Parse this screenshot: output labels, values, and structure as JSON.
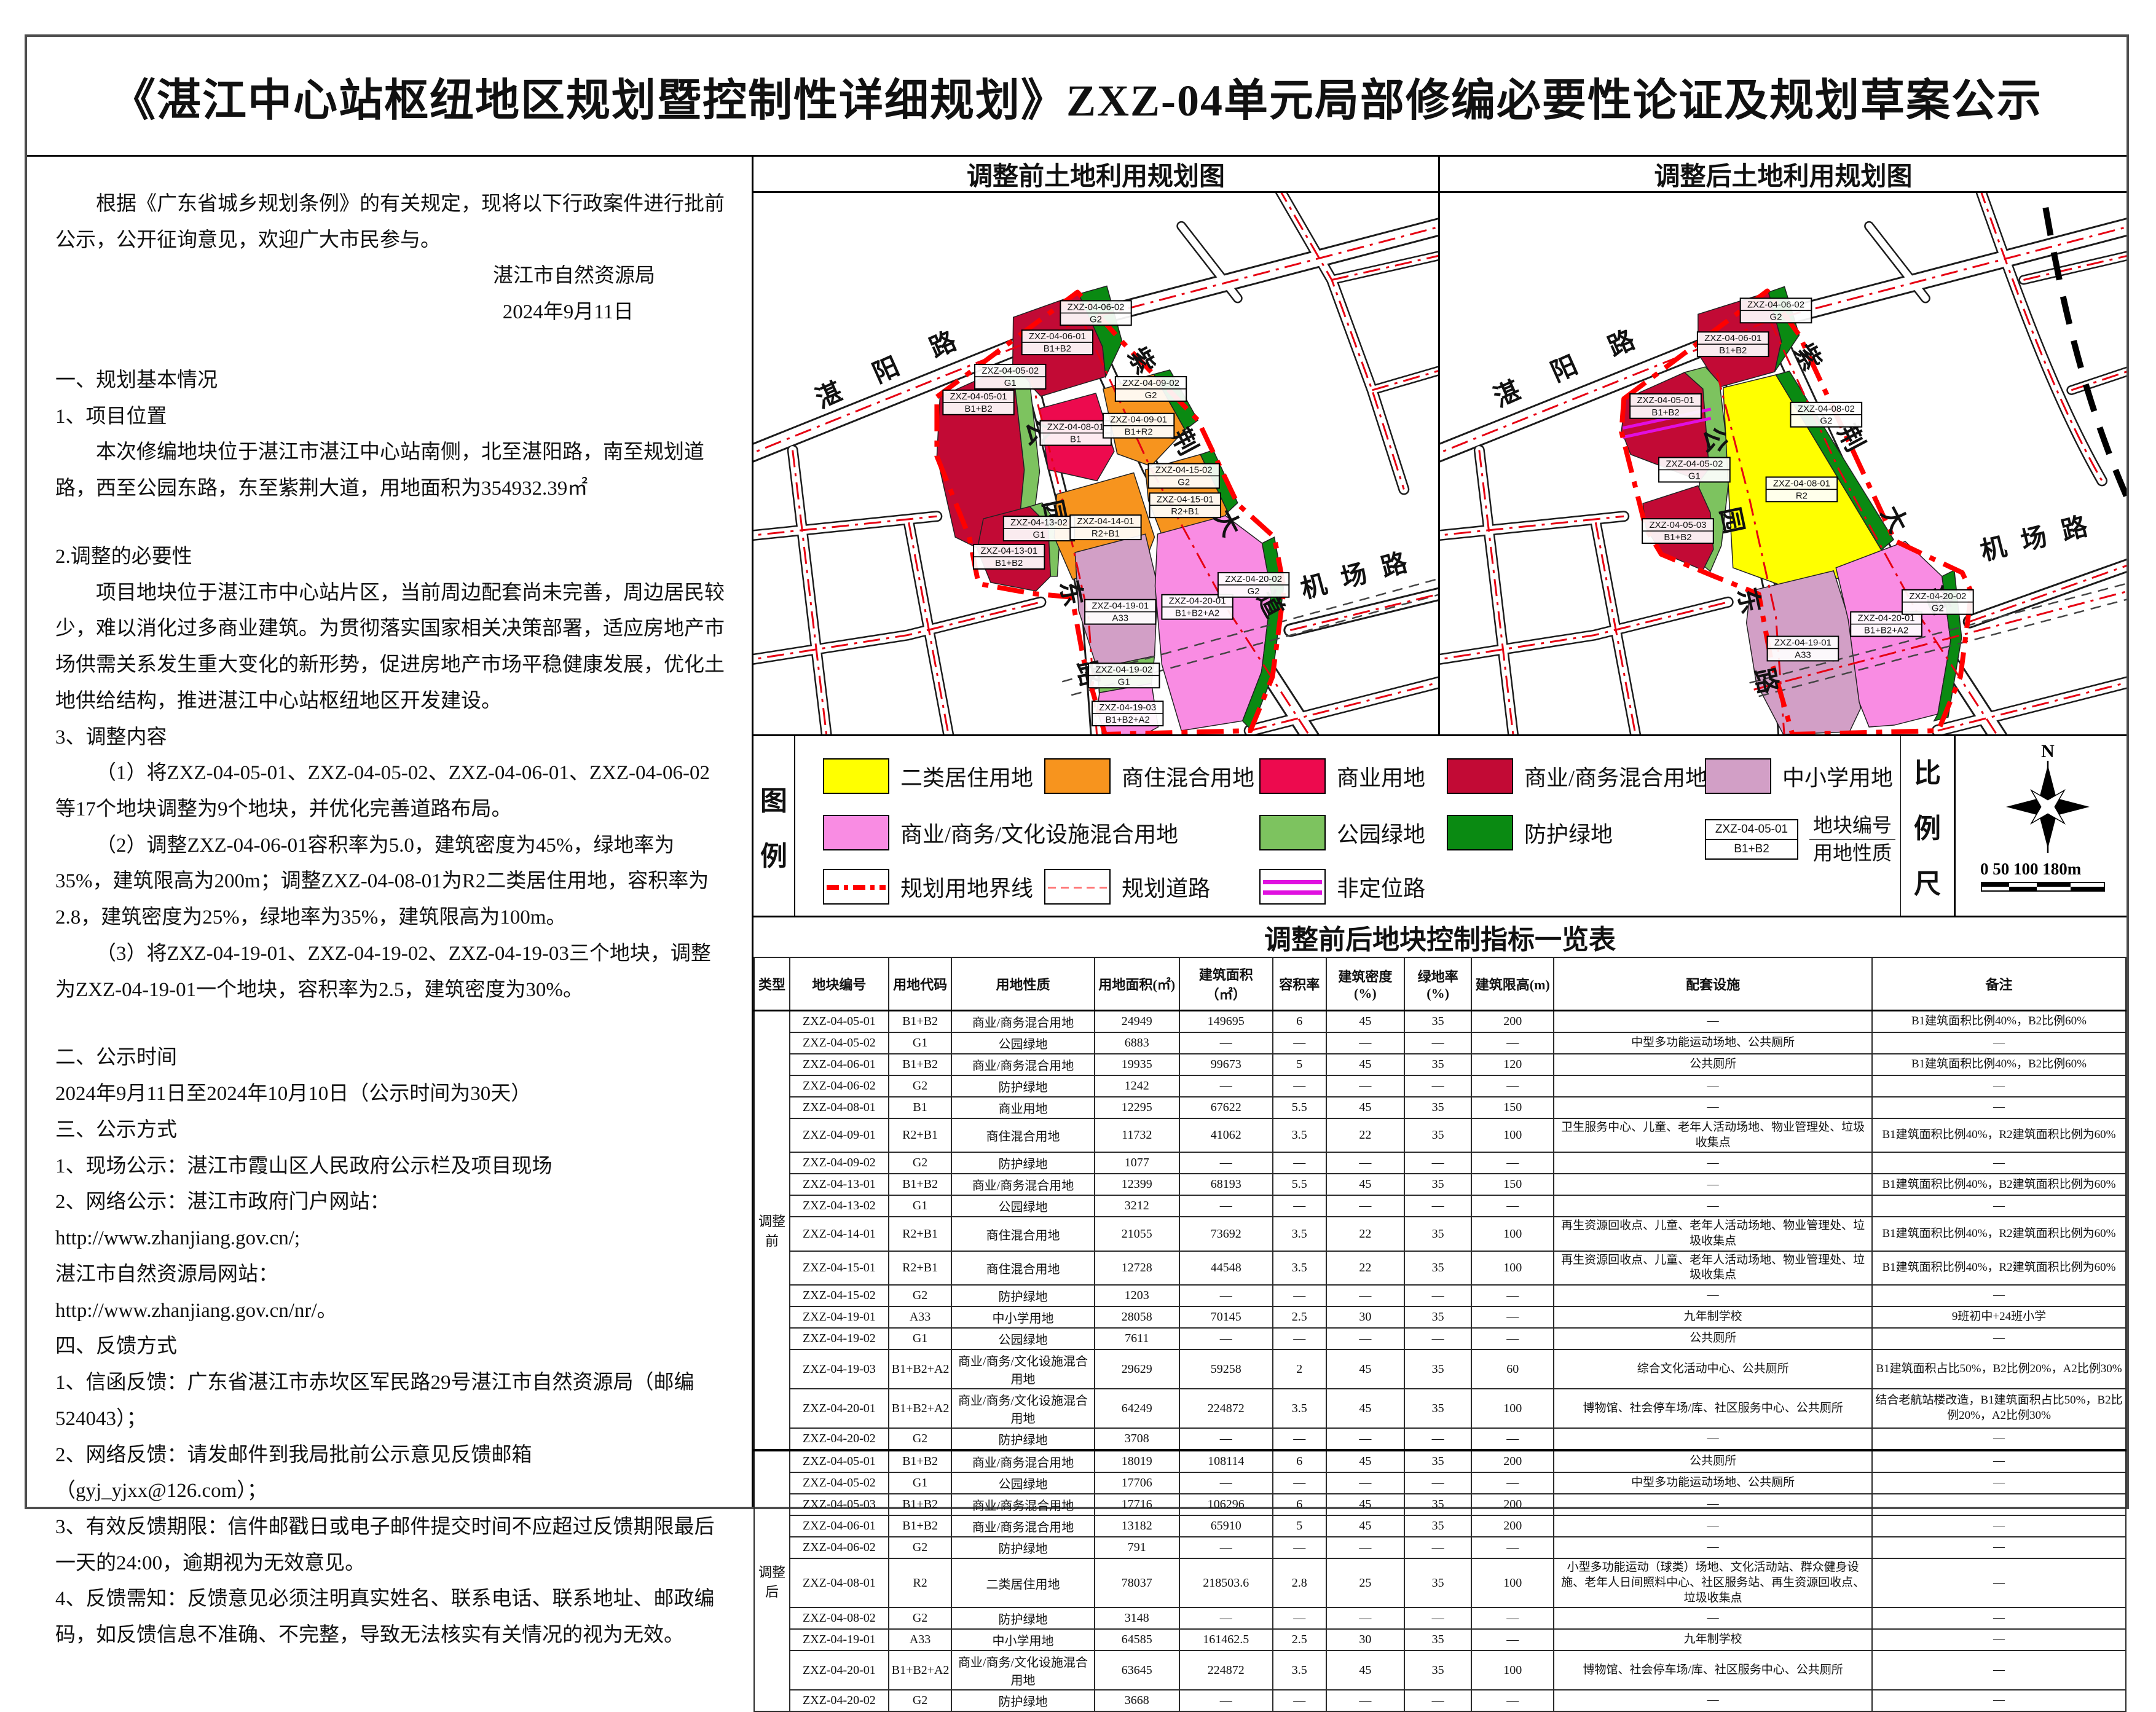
{
  "sheet": {
    "title": "《湛江中心站枢纽地区规划暨控制性详细规划》ZXZ-04单元局部修编必要性论证及规划草案公示"
  },
  "notice": {
    "lines": [
      "根据《广东省城乡规划条例》的有关规定，现将以下行政案件进行批前公示，公开征询意见，欢迎广大市民参与。",
      "湛江市自然资源局",
      "2024年9月11日",
      "一、规划基本情况",
      "1、项目位置",
      "本次修编地块位于湛江市湛江中心站南侧，北至湛阳路，南至规划道路，西至公园东路，东至紫荆大道，用地面积为354932.39㎡",
      "2.调整的必要性",
      "项目地块位于湛江市中心站片区，当前周边配套尚未完善，周边居民较少，难以消化过多商业建筑。为贯彻落实国家相关决策部署，适应房地产市场供需关系发生重大变化的新形势，促进房地产市场平稳健康发展，优化土地供给结构，推进湛江中心站枢纽地区开发建设。",
      "3、调整内容",
      "（1）将ZXZ-04-05-01、ZXZ-04-05-02、ZXZ-04-06-01、ZXZ-04-06-02等17个地块调整为9个地块，并优化完善道路布局。",
      "（2）调整ZXZ-04-06-01容积率为5.0，建筑密度为45%，绿地率为35%，建筑限高为200m；调整ZXZ-04-08-01为R2二类居住用地，容积率为2.8，建筑密度为25%，绿地率为35%，建筑限高为100m。",
      "（3）将ZXZ-04-19-01、ZXZ-04-19-02、ZXZ-04-19-03三个地块，调整为ZXZ-04-19-01一个地块，容积率为2.5，建筑密度为30%。",
      "二、公示时间",
      "2024年9月11日至2024年10月10日（公示时间为30天）",
      "三、公示方式",
      "1、现场公示：湛江市霞山区人民政府公示栏及项目现场",
      "2、网络公示：湛江市政府门户网站：",
      "http://www.zhanjiang.gov.cn/;",
      "湛江市自然资源局网站：",
      "http://www.zhanjiang.gov.cn/nr/。",
      "四、反馈方式",
      "1、信函反馈：广东省湛江市赤坎区军民路29号湛江市自然资源局（邮编524043）；",
      "2、网络反馈：请发邮件到我局批前公示意见反馈邮箱（gyj_yjxx@126.com）；",
      "3、有效反馈期限：信件邮戳日或电子邮件提交时间不应超过反馈期限最后一天的24:00，逾期视为无效意见。",
      "4、反馈需知：反馈意见必须注明真实姓名、联系电话、联系地址、邮政编码，如反馈信息不准确、不完整，导致无法核实有关情况的视为无效。"
    ]
  },
  "maps": {
    "road_names": {
      "zhanyang": "湛阳路",
      "zijing": "紫荆大道",
      "gongyuan": "公园东路",
      "jichang": "机场路"
    },
    "before": {
      "title": "调整前土地利用规划图",
      "parcels": [
        {
          "code": "ZXZ-04-06-02",
          "use": "G2"
        },
        {
          "code": "ZXZ-04-06-01",
          "use": "B1+B2"
        },
        {
          "code": "ZXZ-04-05-02",
          "use": "G1"
        },
        {
          "code": "ZXZ-04-05-01",
          "use": "B1+B2"
        },
        {
          "code": "ZXZ-04-08-01",
          "use": "B1"
        },
        {
          "code": "ZXZ-04-09-02",
          "use": "G2"
        },
        {
          "code": "ZXZ-04-09-01",
          "use": "B1+R2"
        },
        {
          "code": "ZXZ-04-13-02",
          "use": "G1"
        },
        {
          "code": "ZXZ-04-13-01",
          "use": "B1+B2"
        },
        {
          "code": "ZXZ-04-14-01",
          "use": "R2+B1"
        },
        {
          "code": "ZXZ-04-15-02",
          "use": "G2"
        },
        {
          "code": "ZXZ-04-15-01",
          "use": "R2+B1"
        },
        {
          "code": "ZXZ-04-19-01",
          "use": "A33"
        },
        {
          "code": "ZXZ-04-19-02",
          "use": "G1"
        },
        {
          "code": "ZXZ-04-19-03",
          "use": "B1+B2+A2"
        },
        {
          "code": "ZXZ-04-20-01",
          "use": "B1+B2+A2"
        },
        {
          "code": "ZXZ-04-20-02",
          "use": "G2"
        }
      ]
    },
    "after": {
      "title": "调整后土地利用规划图",
      "parcels": [
        {
          "code": "ZXZ-04-06-02",
          "use": "G2"
        },
        {
          "code": "ZXZ-04-06-01",
          "use": "B1+B2"
        },
        {
          "code": "ZXZ-04-05-01",
          "use": "B1+B2"
        },
        {
          "code": "ZXZ-04-05-02",
          "use": "G1"
        },
        {
          "code": "ZXZ-04-05-03",
          "use": "B1+B2"
        },
        {
          "code": "ZXZ-04-08-02",
          "use": "G2"
        },
        {
          "code": "ZXZ-04-08-01",
          "use": "R2"
        },
        {
          "code": "ZXZ-04-19-01",
          "use": "A33"
        },
        {
          "code": "ZXZ-04-20-01",
          "use": "B1+B2+A2"
        },
        {
          "code": "ZXZ-04-20-02",
          "use": "G2"
        }
      ]
    }
  },
  "legend": {
    "label": "图例",
    "items": [
      {
        "label": "二类居住用地",
        "color": "#FFFF00"
      },
      {
        "label": "商住混合用地",
        "color": "#F7941E"
      },
      {
        "label": "商业用地",
        "color": "#ED0A4E"
      },
      {
        "label": "商业/商务混合用地",
        "color": "#C20A35"
      },
      {
        "label": "中小学用地",
        "color": "#D29FC6"
      },
      {
        "label": "商业/商务/文化设施混合用地",
        "color": "#F98CE3"
      },
      {
        "label": "公园绿地",
        "color": "#7DC35F"
      },
      {
        "label": "防护绿地",
        "color": "#0A8A12"
      }
    ],
    "line_items": [
      {
        "label": "规划用地界线",
        "color": "#FF0000"
      },
      {
        "label": "规划道路",
        "color": "#FF7777"
      },
      {
        "label": "非定位路",
        "color": "#E010E0"
      }
    ],
    "sample": {
      "code": "ZXZ-04-05-01",
      "use": "B1+B2",
      "caption_top": "地块编号",
      "caption_bottom": "用地性质"
    }
  },
  "scale": {
    "label": "比例尺",
    "north": "N",
    "bar_ticks": "0   50  100     180m"
  },
  "table": {
    "title": "调整前后地块控制指标一览表",
    "headers": [
      "类型",
      "地块编号",
      "用地代码",
      "用地性质",
      "用地面积(㎡)",
      "建筑面积（㎡）",
      "容积率",
      "建筑密度(%)",
      "绿地率(%)",
      "建筑限高(m)",
      "配套设施",
      "备注"
    ],
    "groups": [
      {
        "type": "调整前",
        "rows": [
          [
            "ZXZ-04-05-01",
            "B1+B2",
            "商业/商务混合用地",
            "24949",
            "149695",
            "6",
            "45",
            "35",
            "200",
            "—",
            "B1建筑面积比例40%，B2比例60%"
          ],
          [
            "ZXZ-04-05-02",
            "G1",
            "公园绿地",
            "6883",
            "—",
            "—",
            "—",
            "—",
            "—",
            "中型多功能运动场地、公共厕所",
            "—"
          ],
          [
            "ZXZ-04-06-01",
            "B1+B2",
            "商业/商务混合用地",
            "19935",
            "99673",
            "5",
            "45",
            "35",
            "120",
            "公共厕所",
            "B1建筑面积比例40%，B2比例60%"
          ],
          [
            "ZXZ-04-06-02",
            "G2",
            "防护绿地",
            "1242",
            "—",
            "—",
            "—",
            "—",
            "—",
            "—",
            "—"
          ],
          [
            "ZXZ-04-08-01",
            "B1",
            "商业用地",
            "12295",
            "67622",
            "5.5",
            "45",
            "35",
            "150",
            "—",
            "—"
          ],
          [
            "ZXZ-04-09-01",
            "R2+B1",
            "商住混合用地",
            "11732",
            "41062",
            "3.5",
            "22",
            "35",
            "100",
            "卫生服务中心、儿童、老年人活动场地、物业管理处、垃圾收集点",
            "B1建筑面积比例40%，R2建筑面积比例为60%"
          ],
          [
            "ZXZ-04-09-02",
            "G2",
            "防护绿地",
            "1077",
            "—",
            "—",
            "—",
            "—",
            "—",
            "—",
            "—"
          ],
          [
            "ZXZ-04-13-01",
            "B1+B2",
            "商业/商务混合用地",
            "12399",
            "68193",
            "5.5",
            "45",
            "35",
            "150",
            "—",
            "B1建筑面积比例40%，B2建筑面积比例为60%"
          ],
          [
            "ZXZ-04-13-02",
            "G1",
            "公园绿地",
            "3212",
            "—",
            "—",
            "—",
            "—",
            "—",
            "—",
            "—"
          ],
          [
            "ZXZ-04-14-01",
            "R2+B1",
            "商住混合用地",
            "21055",
            "73692",
            "3.5",
            "22",
            "35",
            "100",
            "再生资源回收点、儿童、老年人活动场地、物业管理处、垃圾收集点",
            "B1建筑面积比例40%，R2建筑面积比例为60%"
          ],
          [
            "ZXZ-04-15-01",
            "R2+B1",
            "商住混合用地",
            "12728",
            "44548",
            "3.5",
            "22",
            "35",
            "100",
            "再生资源回收点、儿童、老年人活动场地、物业管理处、垃圾收集点",
            "B1建筑面积比例40%，R2建筑面积比例为60%"
          ],
          [
            "ZXZ-04-15-02",
            "G2",
            "防护绿地",
            "1203",
            "—",
            "—",
            "—",
            "—",
            "—",
            "—",
            "—"
          ],
          [
            "ZXZ-04-19-01",
            "A33",
            "中小学用地",
            "28058",
            "70145",
            "2.5",
            "30",
            "35",
            "—",
            "九年制学校",
            "9班初中+24班小学"
          ],
          [
            "ZXZ-04-19-02",
            "G1",
            "公园绿地",
            "7611",
            "—",
            "—",
            "—",
            "—",
            "—",
            "公共厕所",
            "—"
          ],
          [
            "ZXZ-04-19-03",
            "B1+B2+A2",
            "商业/商务/文化设施混合用地",
            "29629",
            "59258",
            "2",
            "45",
            "35",
            "60",
            "综合文化活动中心、公共厕所",
            "B1建筑面积占比50%，B2比例20%，A2比例30%"
          ],
          [
            "ZXZ-04-20-01",
            "B1+B2+A2",
            "商业/商务/文化设施混合用地",
            "64249",
            "224872",
            "3.5",
            "45",
            "35",
            "100",
            "博物馆、社会停车场/库、社区服务中心、公共厕所",
            "结合老航站楼改造，B1建筑面积占比50%，B2比例20%，A2比例30%"
          ],
          [
            "ZXZ-04-20-02",
            "G2",
            "防护绿地",
            "3708",
            "—",
            "—",
            "—",
            "—",
            "—",
            "—",
            "—"
          ]
        ]
      },
      {
        "type": "调整后",
        "rows": [
          [
            "ZXZ-04-05-01",
            "B1+B2",
            "商业/商务混合用地",
            "18019",
            "108114",
            "6",
            "45",
            "35",
            "200",
            "公共厕所",
            "—"
          ],
          [
            "ZXZ-04-05-02",
            "G1",
            "公园绿地",
            "17706",
            "—",
            "—",
            "—",
            "—",
            "—",
            "中型多功能运动场地、公共厕所",
            "—"
          ],
          [
            "ZXZ-04-05-03",
            "B1+B2",
            "商业/商务混合用地",
            "17716",
            "106296",
            "6",
            "45",
            "35",
            "200",
            "—",
            ""
          ],
          [
            "ZXZ-04-06-01",
            "B1+B2",
            "商业/商务混合用地",
            "13182",
            "65910",
            "5",
            "45",
            "35",
            "200",
            "—",
            "—"
          ],
          [
            "ZXZ-04-06-02",
            "G2",
            "防护绿地",
            "791",
            "—",
            "—",
            "—",
            "—",
            "—",
            "—",
            "—"
          ],
          [
            "ZXZ-04-08-01",
            "R2",
            "二类居住用地",
            "78037",
            "218503.6",
            "2.8",
            "25",
            "35",
            "100",
            "小型多功能运动（球类）场地、文化活动站、群众健身设施、老年人日间照料中心、社区服务站、再生资源回收点、垃圾收集点",
            "—"
          ],
          [
            "ZXZ-04-08-02",
            "G2",
            "防护绿地",
            "3148",
            "—",
            "—",
            "—",
            "—",
            "—",
            "—",
            "—"
          ],
          [
            "ZXZ-04-19-01",
            "A33",
            "中小学用地",
            "64585",
            "161462.5",
            "2.5",
            "30",
            "35",
            "—",
            "九年制学校",
            "—"
          ],
          [
            "ZXZ-04-20-01",
            "B1+B2+A2",
            "商业/商务/文化设施混合用地",
            "63645",
            "224872",
            "3.5",
            "45",
            "35",
            "100",
            "博物馆、社会停车场/库、社区服务中心、公共厕所",
            "—"
          ],
          [
            "ZXZ-04-20-02",
            "G2",
            "防护绿地",
            "3668",
            "—",
            "—",
            "—",
            "—",
            "—",
            "—",
            "—"
          ]
        ]
      }
    ]
  }
}
